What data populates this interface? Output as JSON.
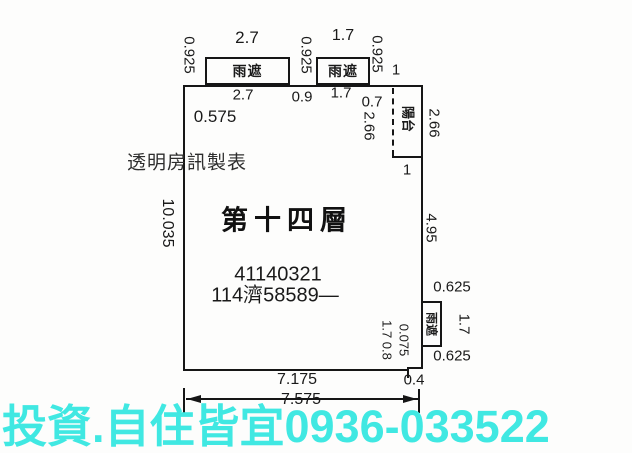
{
  "plan": {
    "floor_title": "第十四層",
    "id_number": "41140321",
    "case_number": "114濟58589—",
    "credit": "透明房訊製表",
    "labels": {
      "rain_shade": "雨遮",
      "balcony": "陽台"
    },
    "dimensions": {
      "top_gap_1": "0.925",
      "top_shade1_w": "2.7",
      "top_gap_2": "0.925",
      "top_shade2_w": "1.7",
      "top_gap_3": "0.925",
      "top_balcony_w": "1",
      "inner_top_1": "2.7",
      "inner_top_2": "0.9",
      "inner_top_3": "1.7",
      "inner_top_4": "0.7",
      "inner_left_offset": "0.575",
      "left_height": "10.035",
      "balcony_h_inner": "2.66",
      "balcony_h_outer": "2.66",
      "balcony_w_bottom": "1",
      "right_height": "4.95",
      "right_gap_top": "0.625",
      "right_shade_h": "1.7",
      "right_gap_bottom": "0.625",
      "step_depth": "0.075",
      "step_inner": "1.7 0.8",
      "bottom_main": "7.175",
      "bottom_step": "0.4",
      "bottom_total": "7.575"
    }
  },
  "watermark": {
    "text": "投資.自住皆宜0936-033522",
    "color": "#40E8E2"
  }
}
